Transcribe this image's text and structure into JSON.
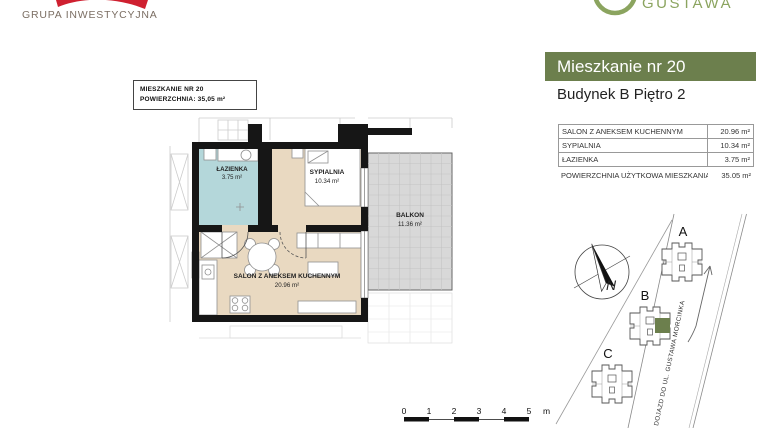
{
  "theme": {
    "accent_green": "#6c7f4d",
    "logo_red": "#cf2030",
    "logo_green": "#8ba45f",
    "floor_beige": "#e9d9c1",
    "bath_blue": "#b4d7da",
    "balcony_gray": "#d8d8d8"
  },
  "branding": {
    "group_name": "GRUPA INWESTYCYJNA",
    "estate_name": "GUSTAWA"
  },
  "header": {
    "title": "Mieszkanie nr 20",
    "subtitle": "Budynek B Piętro 2"
  },
  "plan_label": {
    "line1": "MIESZKANIE NR 20",
    "line2": "POWIERZCHNIA: 35,05 m²"
  },
  "rooms_table": {
    "rows": [
      {
        "label": "SALON Z ANEKSEM KUCHENNYM",
        "value": "20.96 m²"
      },
      {
        "label": "SYPIALNIA",
        "value": "10.34 m²"
      },
      {
        "label": "ŁAZIENKA",
        "value": "3.75 m²"
      }
    ],
    "summary": {
      "label": "POWIERZCHNIA UŻYTKOWA MIESZKANIA",
      "value": "35.05 m²"
    }
  },
  "floorplan": {
    "rooms": [
      {
        "name": "ŁAZIENKA",
        "area": "3.75 m²"
      },
      {
        "name": "SYPIALNIA",
        "area": "10.34 m²"
      },
      {
        "name": "BALKON",
        "area": "11.36 m²"
      },
      {
        "name": "SALON Z ANEKSEM KUCHENNYM",
        "area": "20.96 m²"
      }
    ]
  },
  "site_plan": {
    "compass_label": "N",
    "buildings": [
      "A",
      "B",
      "C"
    ],
    "road_label": "DOJAZD DO UL. GUSTAWA MORCINKA"
  },
  "scale_bar": {
    "ticks": [
      "0",
      "1",
      "2",
      "3",
      "4",
      "5"
    ],
    "unit": "m"
  }
}
